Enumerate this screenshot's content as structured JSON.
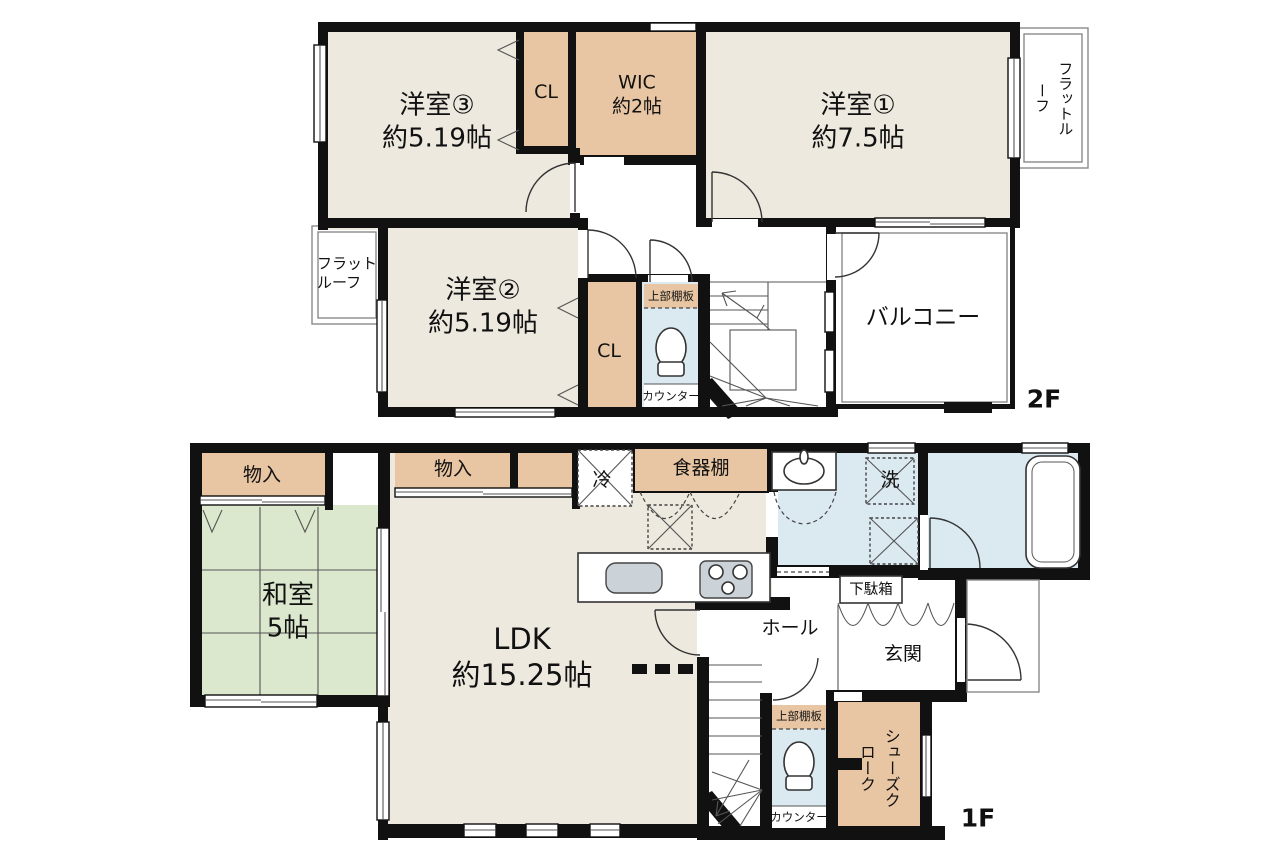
{
  "plan_title": "2-story house floor plan",
  "colors": {
    "room_floor": "#EDE9DF",
    "closet": "#E9C6A3",
    "tatami": "#DCE8CD",
    "wet_area": "#DBE9F1",
    "wall": "#111111"
  },
  "floor2": {
    "tag": "2F",
    "room1_name": "洋室①",
    "room1_size": "約7.5帖",
    "room2_name": "洋室②",
    "room2_size": "約5.19帖",
    "room3_name": "洋室③",
    "room3_size": "約5.19帖",
    "cl_a": "CL",
    "cl_b": "CL",
    "wic_name": "WIC",
    "wic_size": "約2帖",
    "balcony": "バルコニー",
    "flat_roof_right": "フラットルーフ",
    "flat_roof_left": "フラット\nルーフ",
    "toilet_shelf": "上部棚板",
    "toilet_counter": "カウンター"
  },
  "floor1": {
    "tag": "1F",
    "storage_a": "物入",
    "storage_b": "物入",
    "washitsu_name": "和室",
    "washitsu_size": "5帖",
    "ldk_name": "LDK",
    "ldk_size": "約15.25帖",
    "fridge": "冷",
    "cupboard": "食器棚",
    "laundry": "洗",
    "getabako": "下駄箱",
    "hall": "ホール",
    "genkan": "玄関",
    "shoes_cloak": "シューズクローク",
    "toilet_shelf": "上部棚板",
    "toilet_counter": "カウンター"
  }
}
